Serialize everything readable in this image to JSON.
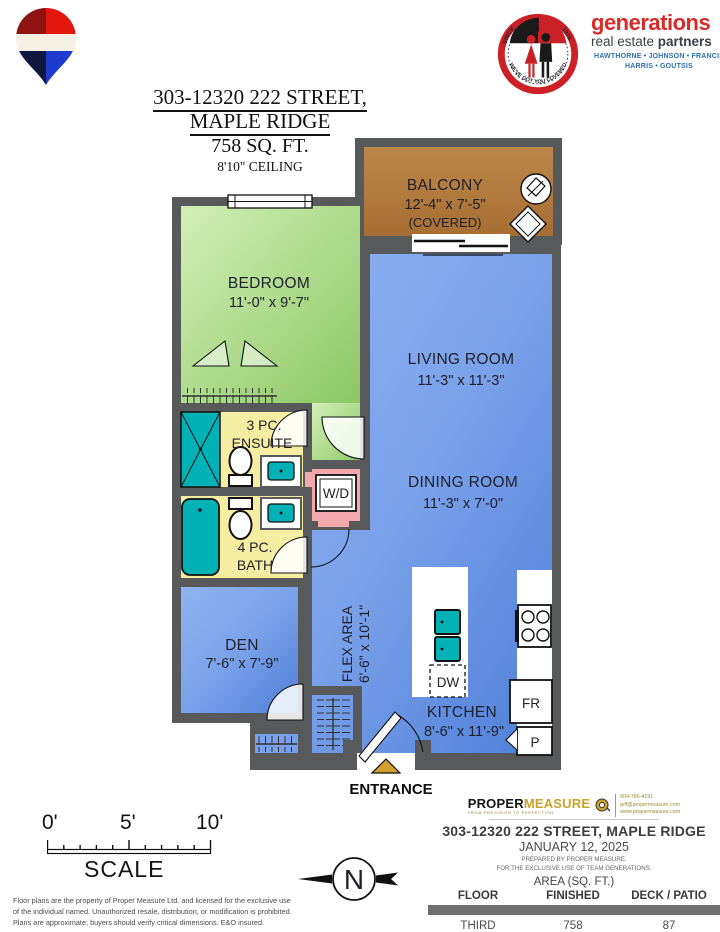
{
  "colors": {
    "wall": "#58595b",
    "bedroom_green": "#a9dd85",
    "living_blue": "#6f9ce8",
    "balcony_brown": "#b3793f",
    "bath_yellow": "#f4eda2",
    "laundry_pink": "#f3a8ad",
    "fixture_teal": "#00b2b6",
    "entrance_gold": "#d4a02c",
    "brand_red": "#d92b27",
    "brand_blue": "#2f6fad"
  },
  "header": {
    "address_line1": "303-12320 222 STREET,",
    "address_line2": "MAPLE RIDGE",
    "area": "758 SQ. FT.",
    "ceiling": "8'10\" CEILING"
  },
  "brand": {
    "name": "generations",
    "tagline_normal": "real estate ",
    "tagline_bold": "partners",
    "agents_line1": "HAWTHORNE • JOHNSON • FRANCIS",
    "agents_line2": "HARRIS • GOUTSIS",
    "badge_since": "SINCE",
    "badge_year": "1976",
    "badge_bottom": "WE'VE GOT YOU COVERED"
  },
  "plan": {
    "balcony": {
      "name": "BALCONY",
      "dims": "12'-4\" x 7'-5\"",
      "note": "(COVERED)"
    },
    "bedroom": {
      "name": "BEDROOM",
      "dims": "11'-0\" x 9'-7\""
    },
    "living": {
      "name": "LIVING ROOM",
      "dims": "11'-3\" x 11'-3\""
    },
    "dining": {
      "name": "DINING ROOM",
      "dims": "11'-3\" x 7'-0\""
    },
    "ensuite": {
      "line1": "3 PC.",
      "line2": "ENSUITE"
    },
    "bath": {
      "line1": "4 PC.",
      "line2": "BATH"
    },
    "laundry": {
      "label": "W/D"
    },
    "den": {
      "name": "DEN",
      "dims": "7'-6\" x 7'-9\""
    },
    "flex": {
      "name": "FLEX AREA",
      "dims": "6'-6\" x 10'-1\""
    },
    "kitchen": {
      "name": "KITCHEN",
      "dims": "8'-6\" x 11'-9\""
    },
    "appliances": {
      "dishwasher": "DW",
      "fridge": "FR",
      "pantry": "P"
    },
    "entrance": "ENTRANCE"
  },
  "scale_bar": {
    "tick0": "0'",
    "tick5": "5'",
    "tick10": "10'",
    "label": "SCALE"
  },
  "compass": {
    "north": "N"
  },
  "disclaimer": {
    "line1": "Floor plans are the property of Proper Measure Ltd. and licensed for the exclusive use",
    "line2": "of the individual named. Unauthorized resale, distribution, or modification is prohibited.",
    "line3": "Plans are approximate; buyers should verify critical dimensions. E&O insured."
  },
  "footer": {
    "logo_part1": "PROPER",
    "logo_part2": "MEASURE",
    "logo_tagline": "FROM PRECISION TO PERFECTION",
    "phone": "604-786-4191",
    "email": "jeff@propermeasure.com",
    "website": "www.propermeasure.com",
    "address": "303-12320 222 STREET, MAPLE RIDGE",
    "date": "JANUARY 12, 2025",
    "prepared_by": "PREPARED BY PROPER MEASURE.",
    "exclusive_use": "FOR THE EXCLUSIVE USE OF TEAM GENERATIONS.",
    "area_heading": "AREA (SQ. FT.)",
    "table": {
      "headers": [
        "FLOOR",
        "FINISHED",
        "DECK / PATIO"
      ],
      "rows": [
        [
          "THIRD",
          "758",
          "87"
        ]
      ]
    }
  }
}
